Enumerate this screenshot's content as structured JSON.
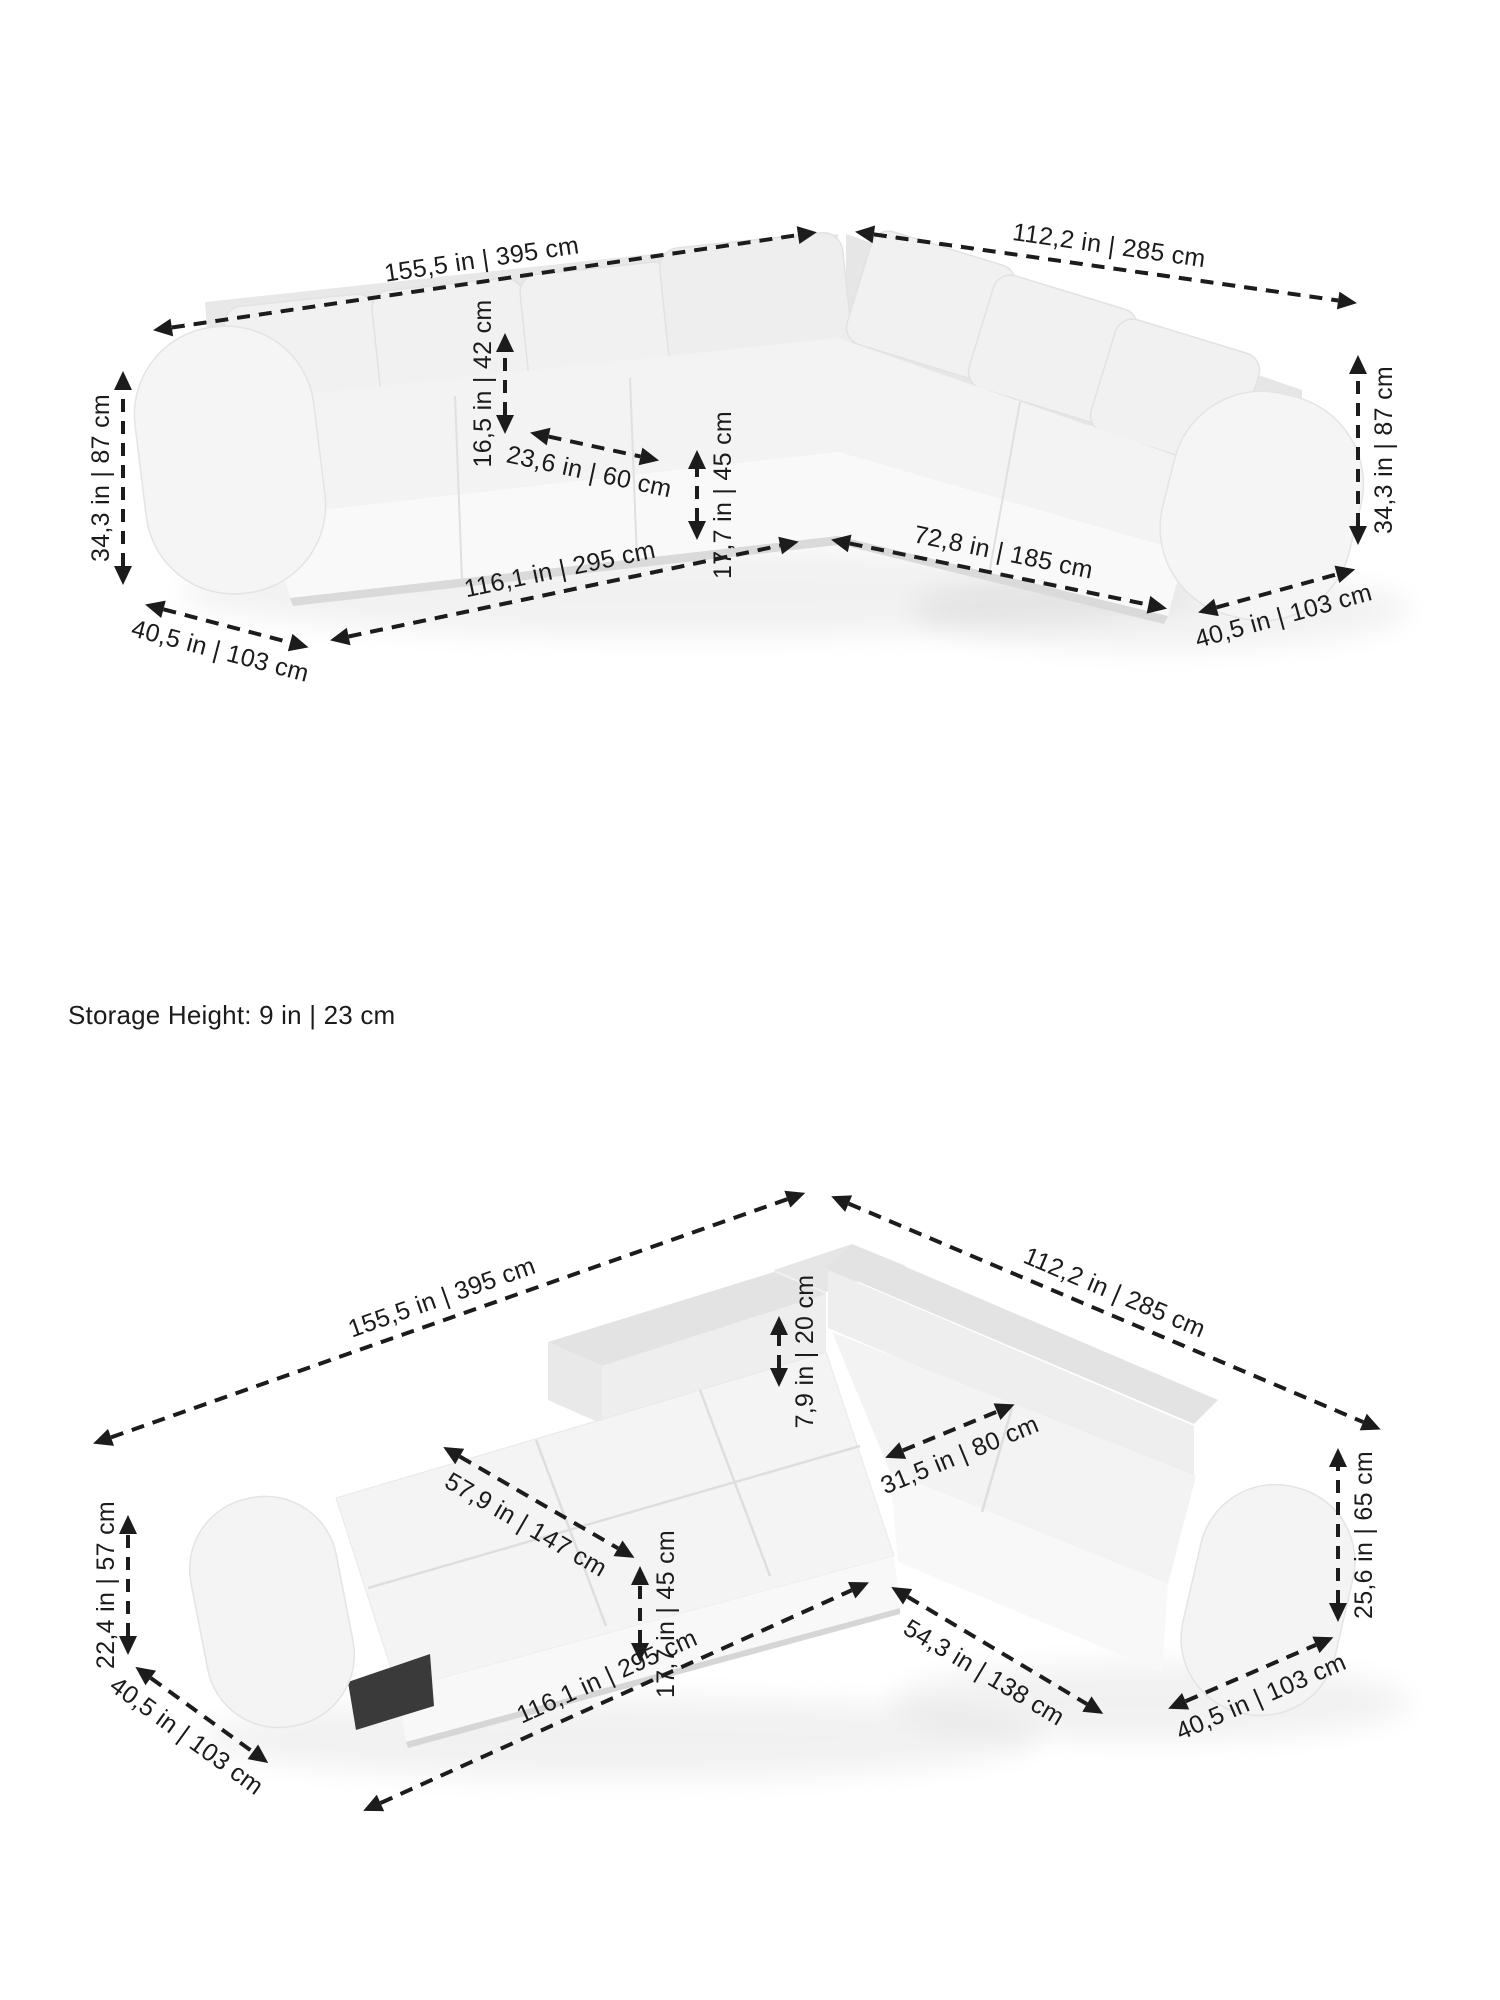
{
  "page": {
    "background_color": "#ffffff",
    "width_px": 1500,
    "height_px": 2000
  },
  "colors": {
    "dimension_lines": "#1c1c1c",
    "sofa_fill_light": "#f5f5f5",
    "sofa_fill_mid": "#ededed",
    "sofa_fill_dark": "#e4e4e4",
    "under_bed_gap": "#3a3a3a",
    "floor_shadow": "#000000"
  },
  "storage_note": "Storage Height: 9 in | 23 cm",
  "diagrams": [
    {
      "name": "sofa-configuration",
      "description": "corner sectional sofa, isometric view with dimension arrows",
      "dimensions": [
        {
          "id": "back-edge-length-left",
          "label": "155,5 in | 395 cm"
        },
        {
          "id": "back-edge-length-right",
          "label": "112,2 in | 285 cm"
        },
        {
          "id": "back-cushion-height",
          "label": "16,5 in | 42 cm"
        },
        {
          "id": "seat-depth",
          "label": "23,6 in | 60 cm"
        },
        {
          "id": "seat-height",
          "label": "17,7 in | 45 cm"
        },
        {
          "id": "overall-height-left",
          "label": "34,3 in | 87 cm"
        },
        {
          "id": "overall-height-right",
          "label": "34,3 in | 87 cm"
        },
        {
          "id": "front-edge-length-left",
          "label": "116,1 in | 295 cm"
        },
        {
          "id": "front-edge-length-right",
          "label": "72,8 in | 185 cm"
        },
        {
          "id": "end-depth-left",
          "label": "40,5 in | 103 cm"
        },
        {
          "id": "end-depth-right",
          "label": "40,5 in | 103 cm"
        }
      ]
    },
    {
      "name": "sofa-bed-configuration",
      "description": "corner sectional converted to bed, isometric view with dimension arrows",
      "dimensions": [
        {
          "id": "back-edge-length-left",
          "label": "155,5 in | 395 cm"
        },
        {
          "id": "back-edge-length-right",
          "label": "112,2 in | 285 cm"
        },
        {
          "id": "backrest-above-bed-height",
          "label": "7,9 in | 20 cm"
        },
        {
          "id": "corner-seat-width",
          "label": "31,5 in | 80 cm"
        },
        {
          "id": "bed-width",
          "label": "57,9 in | 147 cm"
        },
        {
          "id": "bed-height",
          "label": "17,7 in | 45 cm"
        },
        {
          "id": "armrest-height-left",
          "label": "22,4 in | 57 cm"
        },
        {
          "id": "side-height-right",
          "label": "25,6 in | 65 cm"
        },
        {
          "id": "front-edge-length",
          "label": "116,1 in | 295 cm"
        },
        {
          "id": "chaise-front-length",
          "label": "54,3 in | 138 cm"
        },
        {
          "id": "end-depth-left",
          "label": "40,5 in | 103 cm"
        },
        {
          "id": "end-depth-right",
          "label": "40,5 in | 103 cm"
        }
      ]
    }
  ]
}
